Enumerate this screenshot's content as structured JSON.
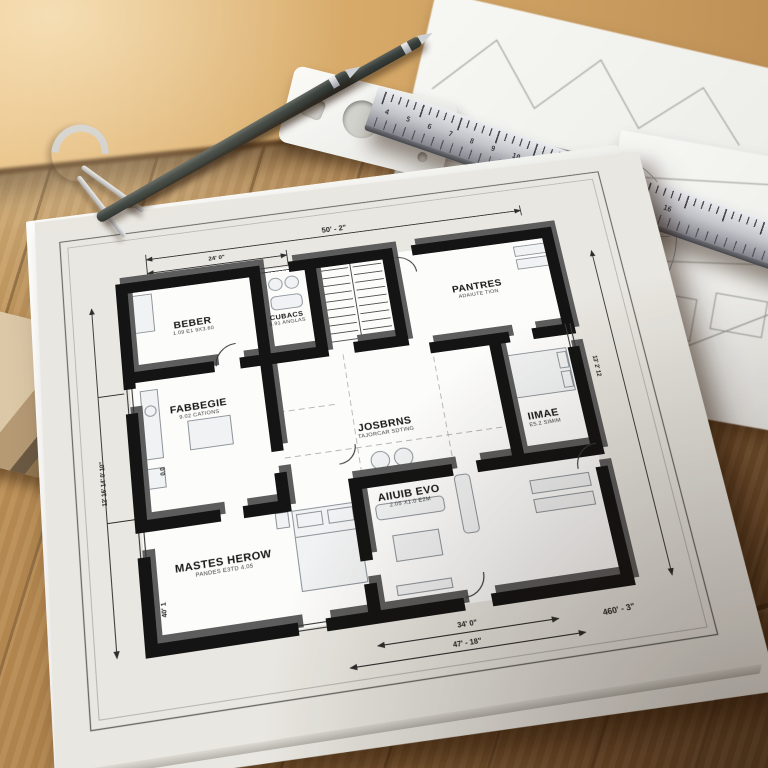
{
  "floorplan": {
    "rooms": [
      {
        "name": "bedroom-top-left",
        "title": "BEBER",
        "sub": "1.09 E1 9X3.60"
      },
      {
        "name": "bathroom",
        "title": "CUBACS",
        "sub": "8.91 ANGLAS"
      },
      {
        "name": "pantry",
        "title": "PANTRES",
        "sub": "ADAIUTE TION"
      },
      {
        "name": "hallway",
        "title": "JOSBRNS",
        "sub": "TAJORCAR SDTING"
      },
      {
        "name": "kitchen",
        "title": "FABBEGIE",
        "sub": "9.02 CATIONS"
      },
      {
        "name": "bedroom-right",
        "title": "IIMAE",
        "sub": "E5.2 SIMIM"
      },
      {
        "name": "living-room",
        "title": "AIIUIB EVO",
        "sub": "2.05 X1.0 E2M"
      },
      {
        "name": "master-bedroom",
        "title": "MASTES HEROW",
        "sub": "PANDES E3TD 4.05"
      }
    ],
    "dimensions": {
      "top": "50' - 2\"",
      "top_inner": "24' 0\"",
      "bottom_inner": "34' 0\"",
      "bottom_outer": "47' - 18\"",
      "right_bottom": "460' - 3\"",
      "left_column": "12' 16' 14' 0' 10\"",
      "left_inner": "0.0",
      "left_lower": "40' 1",
      "right_vertical": "13' 2' 12"
    }
  },
  "ruler": {
    "numbers": "4 5 6 7 8 9 10 11 12 13 14 15 16"
  },
  "colors": {
    "wood": "#a97f4b",
    "paper": "#f6f6f3",
    "wall_ink": "#161616",
    "ruler_metal": "#b9bac0"
  }
}
